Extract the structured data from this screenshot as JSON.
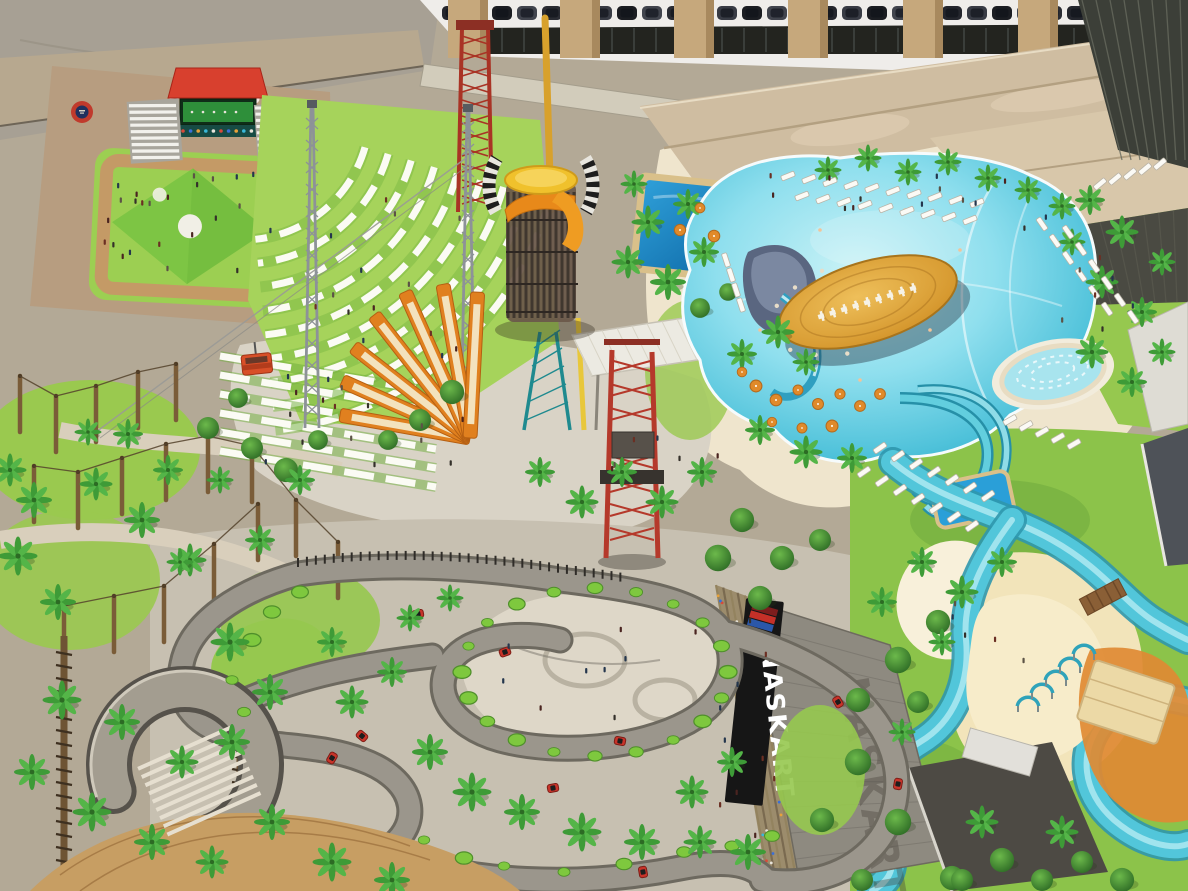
{
  "scene": {
    "type": "aerial architectural rendering",
    "description": "Aerial rendering of a resort amusement and water park: parking garage and resort buildings at top, event lawn with red stage and terraced amphitheater seating at left, zip-line and ride towers, orange sail sculptures, ropes course, a palm-lined lagoon wave pool with a football-shaped swim-up bar island, water slides, a lazy river with island pavilion, a winding go-kart circuit and the NASKART racing building."
  },
  "signs": {
    "naskart": {
      "label": "NASKART",
      "shadow_label": "NASKART",
      "logo_stripe_colors": [
        "#7d1d1d",
        "#c53028",
        "#2b57a8"
      ]
    }
  },
  "palette": {
    "lawn_green": "#8cc34a",
    "sand": "#ecdfc6",
    "pavement": "#a7a094",
    "lagoon_water": "#7fd8e8",
    "deep_pool": "#1f86c4",
    "lazy_river": "#52c6da",
    "football_island": "#d99b33",
    "stage_red": "#d8402e",
    "sail_orange": "#e0801f",
    "tower_red": "#b5392b",
    "track_asphalt": "#9b968c",
    "roof_tan": "#cfbda1",
    "sign_background": "#161616",
    "sign_text": "#ffffff"
  },
  "features": [
    "parking-garage",
    "resort-buildings",
    "event-lawn-stage",
    "amphitheater-lawn",
    "zip-line-towers",
    "spiral-ride-tower",
    "sail-fins",
    "ropes-course",
    "rectangular-pool",
    "lagoon-wave-pool",
    "football-island-bar",
    "water-slides",
    "spa-pool",
    "lazy-river",
    "island-pavilion",
    "naskart-building",
    "go-kart-track",
    "spiral-ramp",
    "palm-trees"
  ]
}
